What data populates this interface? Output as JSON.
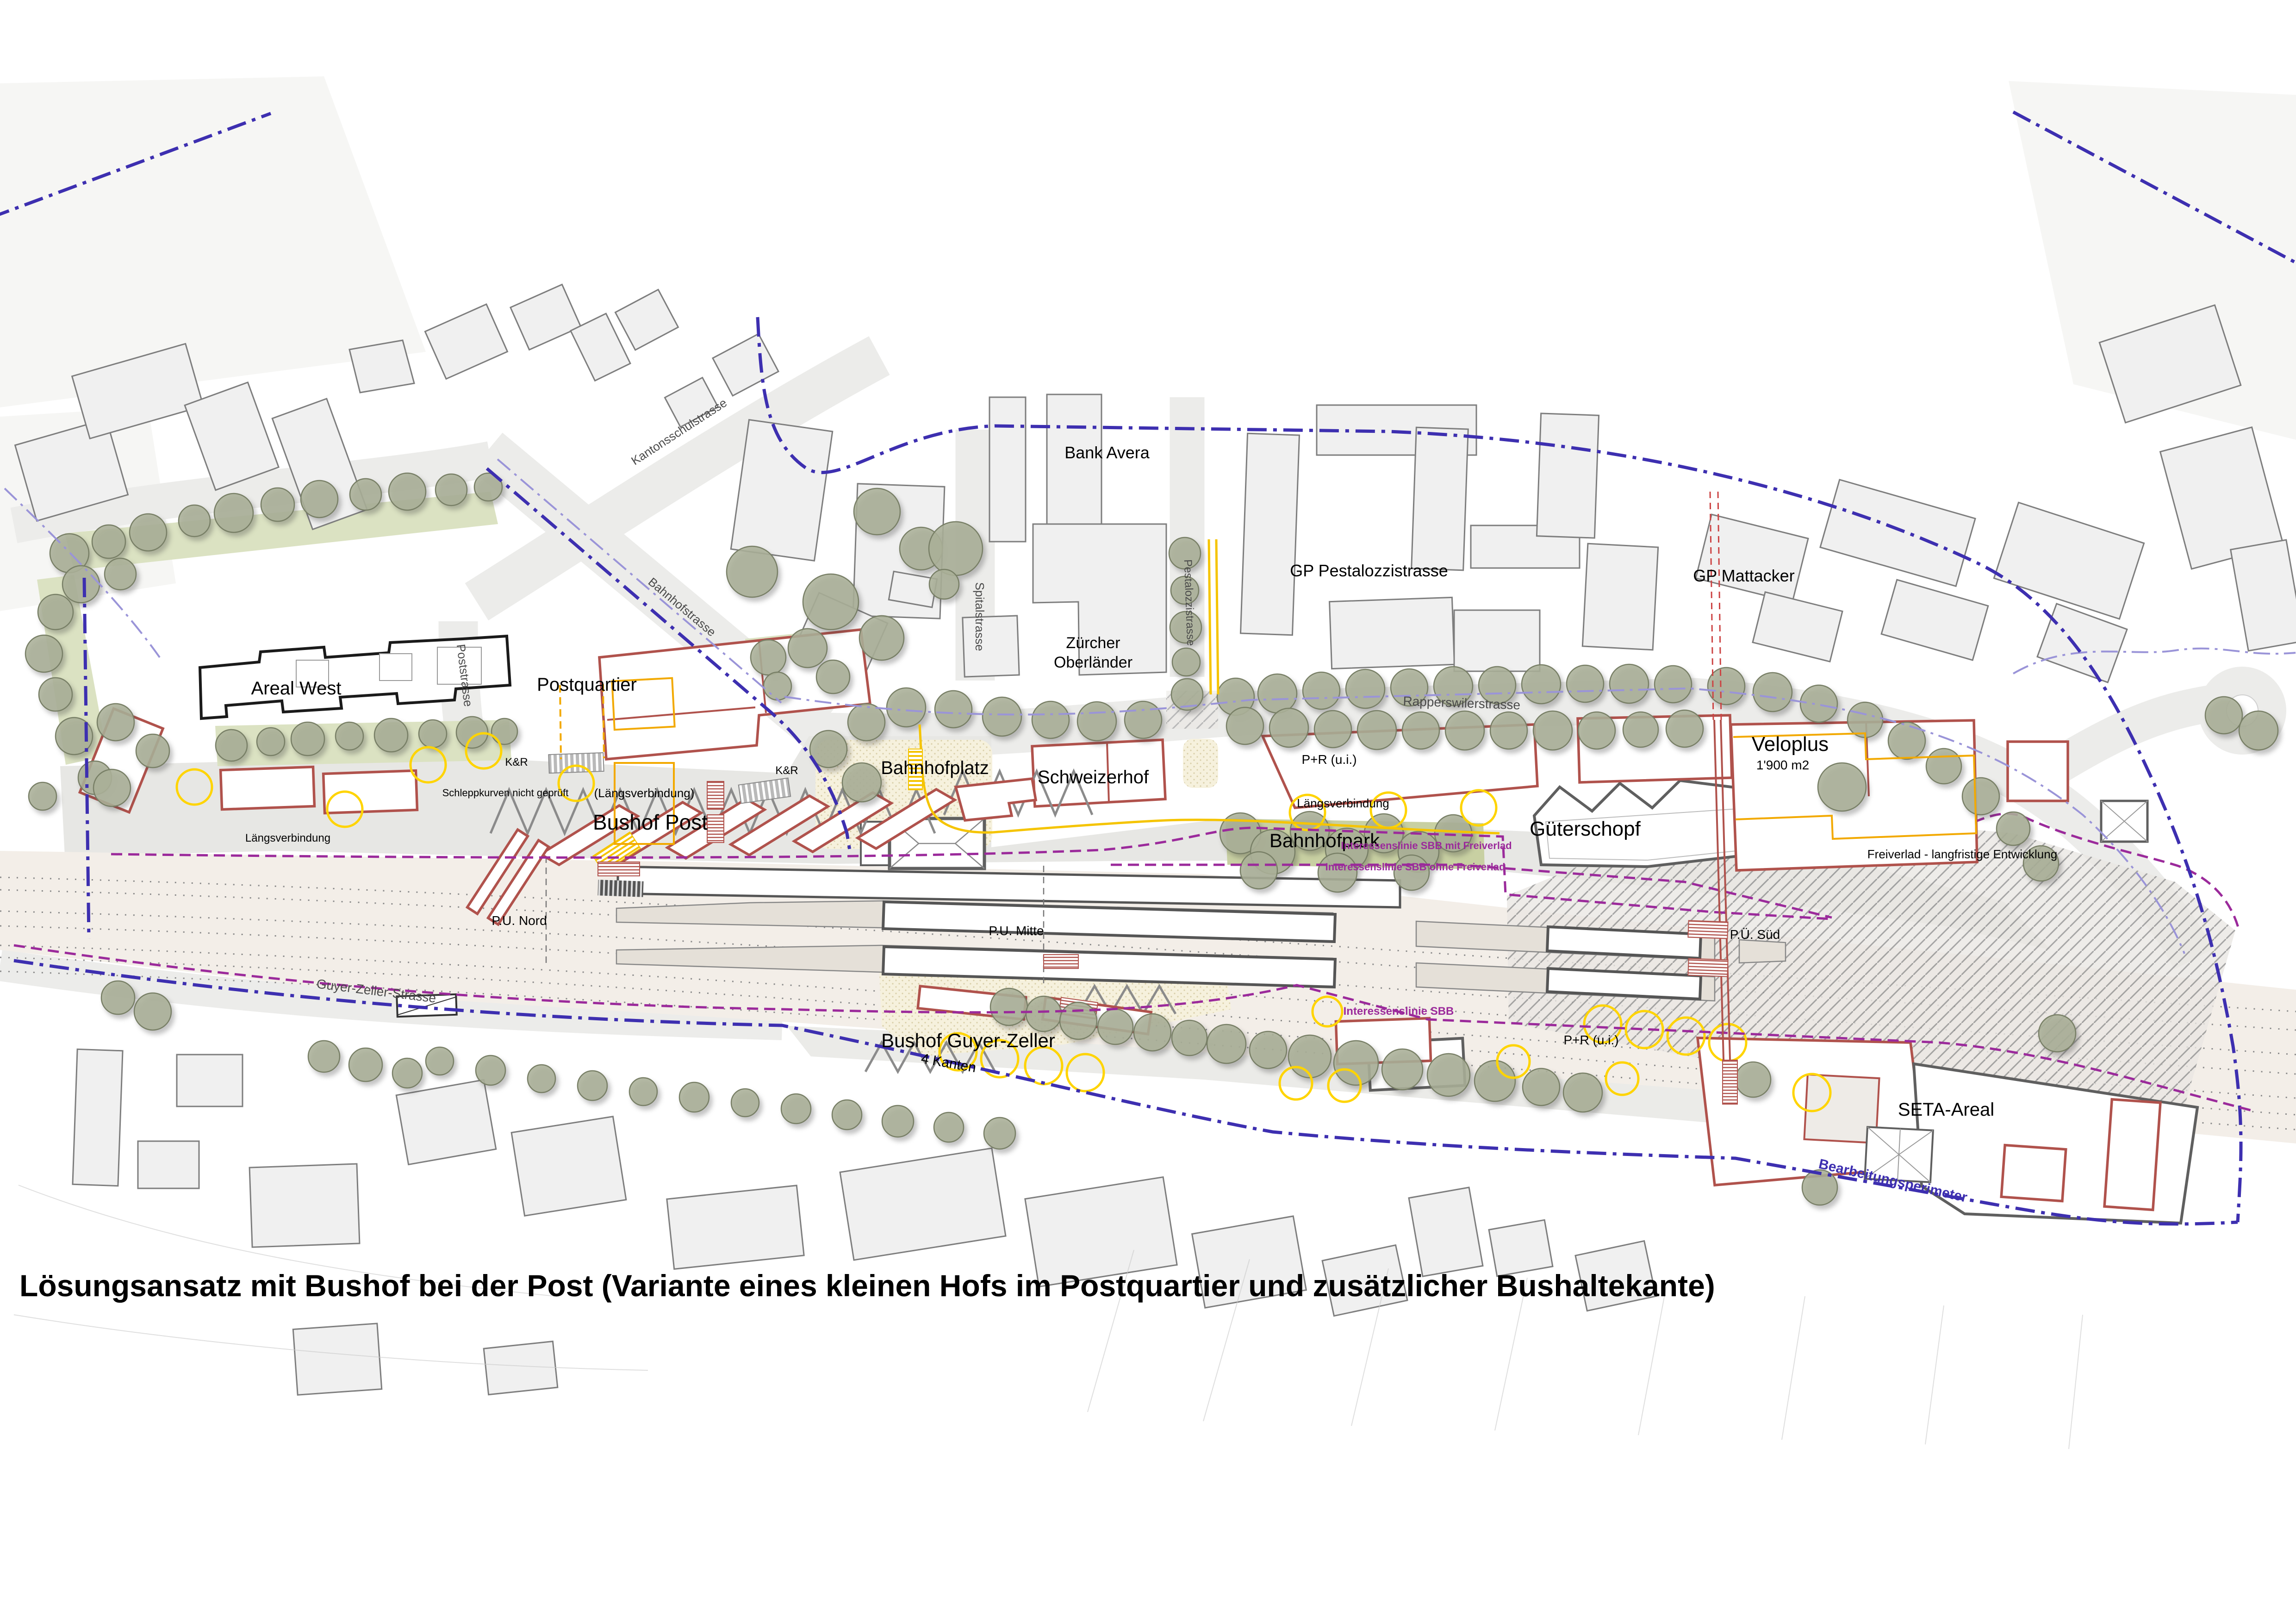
{
  "title": "Lösungsansatz mit Bushof bei der Post (Variante eines kleinen Hofs im Postquartier und zusätzlicher Bushaltekante)",
  "plan": {
    "areas": {
      "areal_west": "Areal West",
      "postquartier": "Postquartier",
      "bahnhofplatz": "Bahnhofplatz",
      "schweizerhof": "Schweizerhof",
      "bank_avera": "Bank Avera",
      "zuercher_oberlaender_1": "Zürcher",
      "zuercher_oberlaender_2": "Oberländer",
      "gp_pestalozzistrasse": "GP Pestalozzistrasse",
      "gp_mattacker": "GP Mattacker",
      "bushof_post": "Bushof Post",
      "bahnhofpark": "Bahnhofpark",
      "gueterschopf": "Güterschopf",
      "veloplus": "Veloplus",
      "veloplus_area": "1'900 m2",
      "bushof_guyer_zeller": "Bushof Guyer-Zeller",
      "vier_kanten": "4 Kanten",
      "seta_areal": "SETA-Areal"
    },
    "streets": {
      "kantonsschulstrasse": "Kantonsschulstrasse",
      "spitalstrasse": "Spitalstrasse",
      "pestalozzistrasse": "Pestalozzistrasse",
      "bahnhofstrasse": "Bahnhofstrasse",
      "poststrasse": "Poststrasse",
      "rapperswilerstrasse": "Rapperswilerstrasse",
      "guyer_zeller_strasse": "Guyer-Zeller-Strasse"
    },
    "annotations": {
      "pr_ui": "P+R (u.i.)",
      "kr": "K&R",
      "laengsverbindung": "Längsverbindung",
      "laengsverbindung_paren": "(Längsverbindung)",
      "schleppkurven": "Schleppkurven nicht geprüft",
      "pu_nord": "P.U. Nord",
      "pu_mitte": "P.U. Mitte",
      "pu_sued": "P.Ü. Süd",
      "bearbeitungsperimeter": "Bearbeitungsperimeter",
      "interessenslinie_mit": "Interessenslinie SBB mit Freiverlad",
      "interessenslinie_ohne": "Interessenslinie SBB ohne Freiverlad",
      "interessenslinie_sbb": "Interessenslinie SBB",
      "freiverlad": "Freiverlad - langfristige Entwicklung"
    },
    "colors": {
      "new_building_outline": "#b0524c",
      "existing_building_fill": "#f0f0f0",
      "tree_fill": "#abb098",
      "perimeter_blue": "#3d2fb0",
      "interest_line_magenta": "#9b2a9b",
      "bus_route_yellow": "#f5c400",
      "plaza_beige": "#f6f1dd",
      "park_green": "#c8d0a2"
    }
  }
}
